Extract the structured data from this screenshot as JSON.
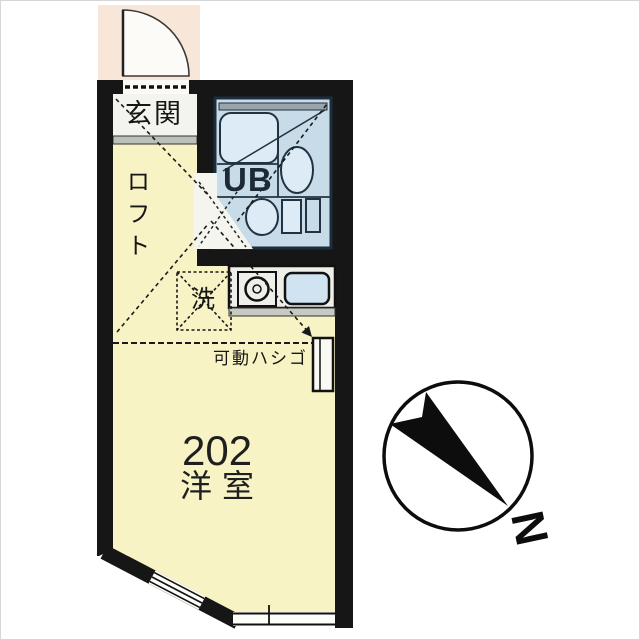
{
  "plan": {
    "unit_number": "202",
    "room_label": "洋室",
    "entrance_label": "玄関",
    "loft_label": "ロフト",
    "unit_bath_label": "UB",
    "washer_label": "洗",
    "ladder_label": "可動ハシゴ",
    "north_label": "N",
    "colors": {
      "wall": "#161616",
      "room": "#f8f3c4",
      "bath": "#c8dbe8",
      "porch": "#f8e7d8",
      "fixture": "#dcebf5",
      "sink": "#cfe3f0"
    }
  }
}
